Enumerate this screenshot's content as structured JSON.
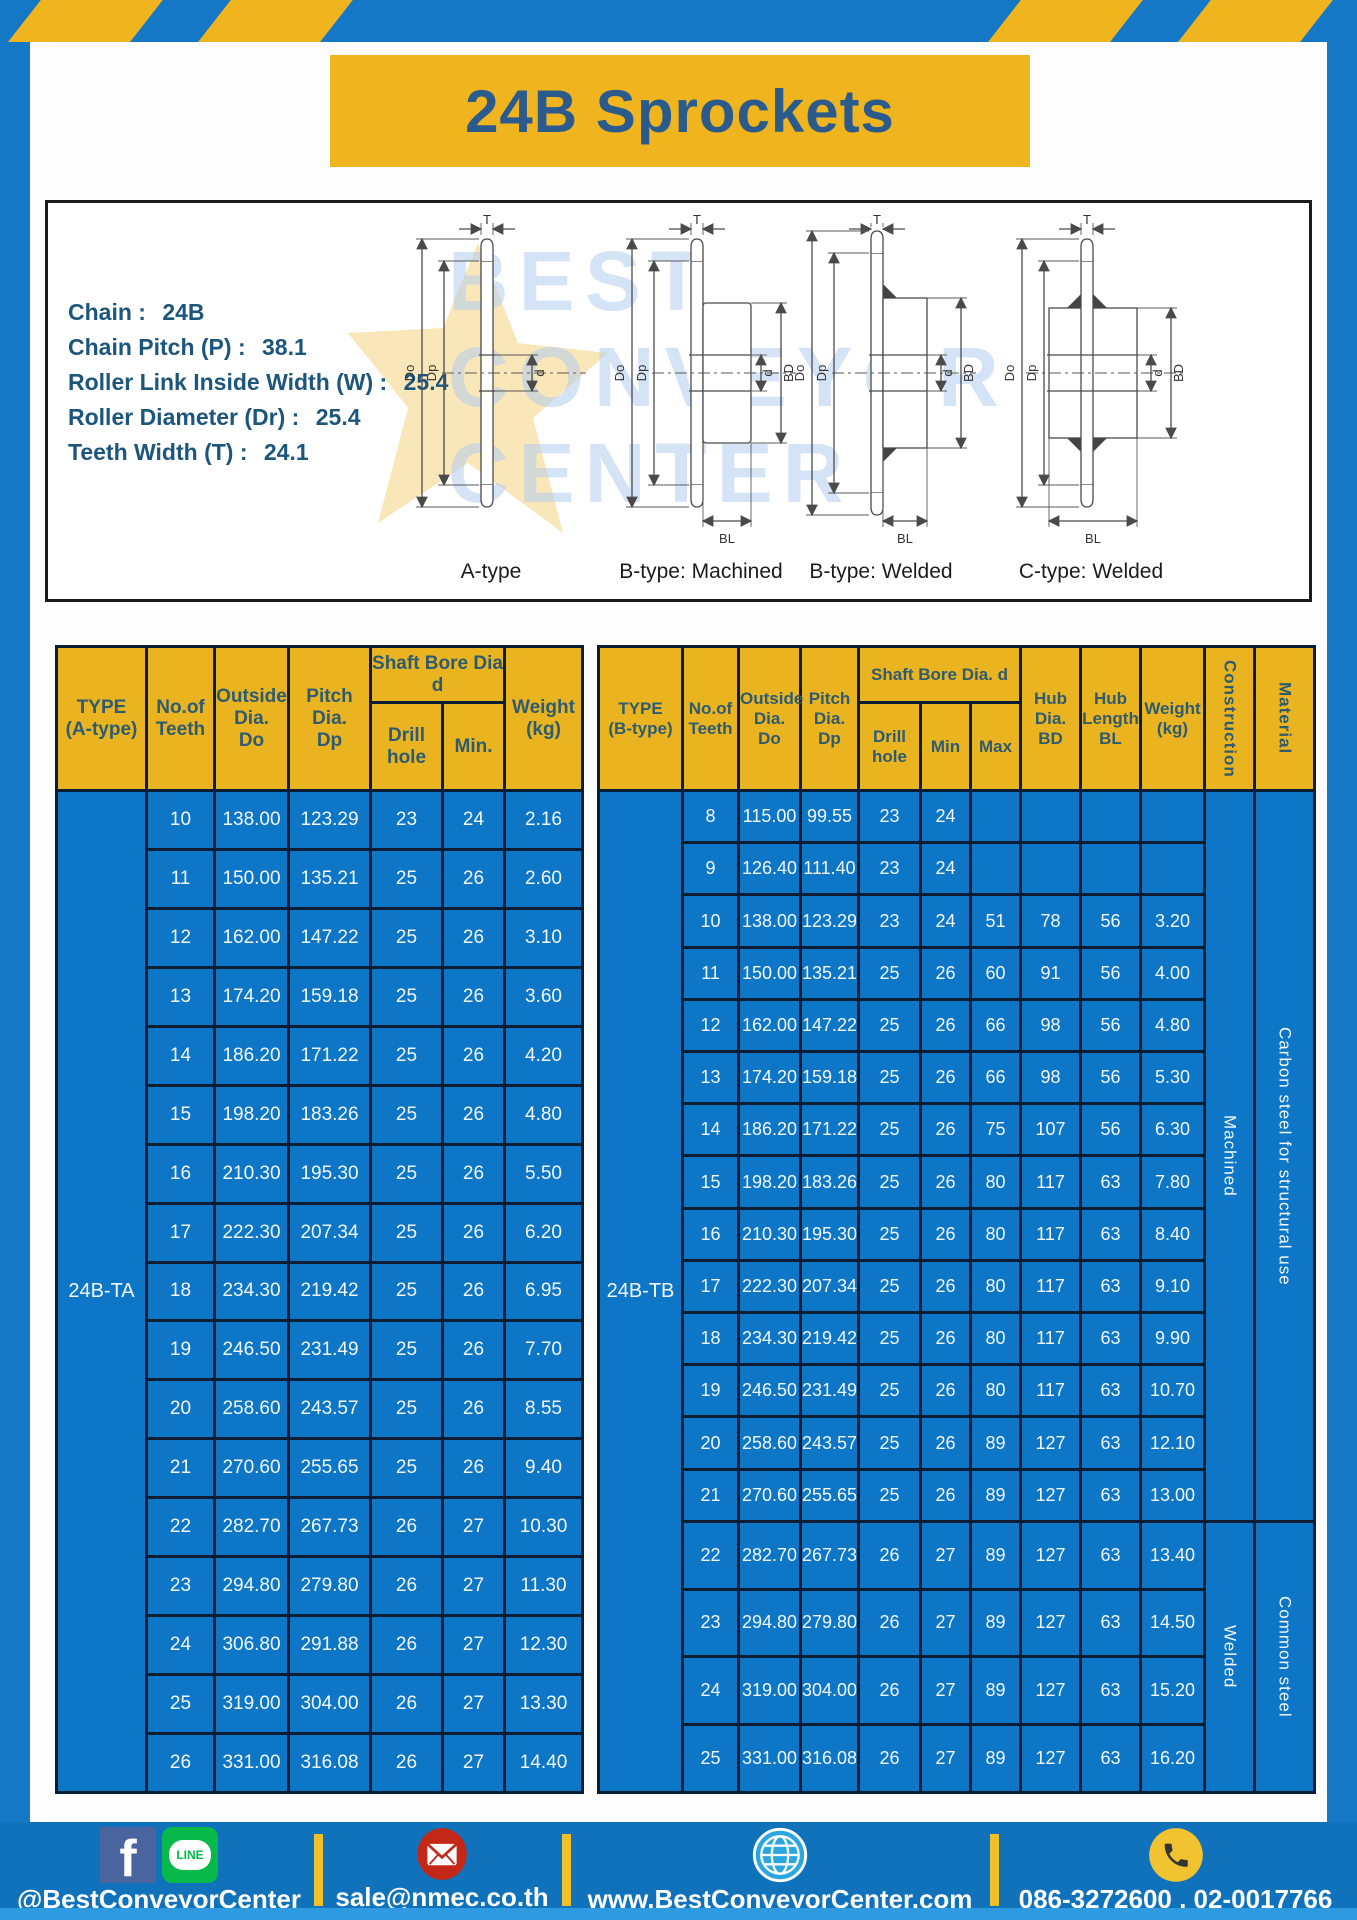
{
  "page": {
    "title": "24B Sprockets"
  },
  "colors": {
    "accent_yellow": "#EFB41E",
    "frame_blue": "#1478C6",
    "cell_blue": "#0E76C7",
    "footer_blue": "#1172BC",
    "border_dark": "#0A1D33",
    "header_text": "#2E5B70",
    "title_text": "#2B5B8C"
  },
  "specs": {
    "items": [
      {
        "label": "Chain",
        "value": "24B"
      },
      {
        "label": "Chain Pitch (P)",
        "value": "38.1"
      },
      {
        "label": "Roller Link Inside Width (W)",
        "value": "25.4"
      },
      {
        "label": "Roller Diameter (Dr)",
        "value": "25.4"
      },
      {
        "label": "Teeth Width (T)",
        "value": "24.1"
      }
    ]
  },
  "diagrams": {
    "captions": [
      "A-type",
      "B-type: Machined",
      "B-type: Welded",
      "C-type: Welded"
    ],
    "dim_labels": {
      "t": "T",
      "dia_o": "Do",
      "dia_p": "Dp",
      "d": "d",
      "bd": "BD",
      "bl": "BL"
    },
    "watermark_lines": [
      "BEST",
      "CONVEYOR",
      "CENTER"
    ]
  },
  "table_a": {
    "type_label": "24B-TA",
    "headers": {
      "type": "TYPE\n(A-type)",
      "teeth": "No.of\nTeeth",
      "outside": "Outside\nDia.\nDo",
      "pitch": "Pitch Dia.\nDp",
      "shaft_bore": "Shaft Bore Dia d",
      "drill": "Drill hole",
      "min": "Min.",
      "weight": "Weight\n(kg)"
    },
    "rows": [
      [
        "10",
        "138.00",
        "123.29",
        "23",
        "24",
        "2.16"
      ],
      [
        "11",
        "150.00",
        "135.21",
        "25",
        "26",
        "2.60"
      ],
      [
        "12",
        "162.00",
        "147.22",
        "25",
        "26",
        "3.10"
      ],
      [
        "13",
        "174.20",
        "159.18",
        "25",
        "26",
        "3.60"
      ],
      [
        "14",
        "186.20",
        "171.22",
        "25",
        "26",
        "4.20"
      ],
      [
        "15",
        "198.20",
        "183.26",
        "25",
        "26",
        "4.80"
      ],
      [
        "16",
        "210.30",
        "195.30",
        "25",
        "26",
        "5.50"
      ],
      [
        "17",
        "222.30",
        "207.34",
        "25",
        "26",
        "6.20"
      ],
      [
        "18",
        "234.30",
        "219.42",
        "25",
        "26",
        "6.95"
      ],
      [
        "19",
        "246.50",
        "231.49",
        "25",
        "26",
        "7.70"
      ],
      [
        "20",
        "258.60",
        "243.57",
        "25",
        "26",
        "8.55"
      ],
      [
        "21",
        "270.60",
        "255.65",
        "25",
        "26",
        "9.40"
      ],
      [
        "22",
        "282.70",
        "267.73",
        "26",
        "27",
        "10.30"
      ],
      [
        "23",
        "294.80",
        "279.80",
        "26",
        "27",
        "11.30"
      ],
      [
        "24",
        "306.80",
        "291.88",
        "26",
        "27",
        "12.30"
      ],
      [
        "25",
        "319.00",
        "304.00",
        "26",
        "27",
        "13.30"
      ],
      [
        "26",
        "331.00",
        "316.08",
        "26",
        "27",
        "14.40"
      ]
    ]
  },
  "table_b": {
    "type_label": "24B-TB",
    "headers": {
      "type": "TYPE\n(B-type)",
      "teeth": "No.of\nTeeth",
      "outside": "Outside\nDia.\nDo",
      "pitch": "Pitch\nDia.\nDp",
      "shaft_bore": "Shaft Bore Dia. d",
      "drill": "Drill hole",
      "min": "Min",
      "max": "Max",
      "hub_dia": "Hub\nDia.\nBD",
      "hub_len": "Hub\nLength\nBL",
      "weight": "Weight\n(kg)",
      "construction": "Construction",
      "material": "Material"
    },
    "rows": [
      [
        "8",
        "115.00",
        "99.55",
        "23",
        "24",
        "",
        "",
        "",
        ""
      ],
      [
        "9",
        "126.40",
        "111.40",
        "23",
        "24",
        "",
        "",
        "",
        ""
      ],
      [
        "10",
        "138.00",
        "123.29",
        "23",
        "24",
        "51",
        "78",
        "56",
        "3.20"
      ],
      [
        "11",
        "150.00",
        "135.21",
        "25",
        "26",
        "60",
        "91",
        "56",
        "4.00"
      ],
      [
        "12",
        "162.00",
        "147.22",
        "25",
        "26",
        "66",
        "98",
        "56",
        "4.80"
      ],
      [
        "13",
        "174.20",
        "159.18",
        "25",
        "26",
        "66",
        "98",
        "56",
        "5.30"
      ],
      [
        "14",
        "186.20",
        "171.22",
        "25",
        "26",
        "75",
        "107",
        "56",
        "6.30"
      ],
      [
        "15",
        "198.20",
        "183.26",
        "25",
        "26",
        "80",
        "117",
        "63",
        "7.80"
      ],
      [
        "16",
        "210.30",
        "195.30",
        "25",
        "26",
        "80",
        "117",
        "63",
        "8.40"
      ],
      [
        "17",
        "222.30",
        "207.34",
        "25",
        "26",
        "80",
        "117",
        "63",
        "9.10"
      ],
      [
        "18",
        "234.30",
        "219.42",
        "25",
        "26",
        "80",
        "117",
        "63",
        "9.90"
      ],
      [
        "19",
        "246.50",
        "231.49",
        "25",
        "26",
        "80",
        "117",
        "63",
        "10.70"
      ],
      [
        "20",
        "258.60",
        "243.57",
        "25",
        "26",
        "89",
        "127",
        "63",
        "12.10"
      ],
      [
        "21",
        "270.60",
        "255.65",
        "25",
        "26",
        "89",
        "127",
        "63",
        "13.00"
      ],
      [
        "22",
        "282.70",
        "267.73",
        "26",
        "27",
        "89",
        "127",
        "63",
        "13.40"
      ],
      [
        "23",
        "294.80",
        "279.80",
        "26",
        "27",
        "89",
        "127",
        "63",
        "14.50"
      ],
      [
        "24",
        "319.00",
        "304.00",
        "26",
        "27",
        "89",
        "127",
        "63",
        "15.20"
      ],
      [
        "25",
        "331.00",
        "316.08",
        "26",
        "27",
        "89",
        "127",
        "63",
        "16.20"
      ]
    ],
    "groups": [
      {
        "start": 0,
        "span": 14,
        "construction": "Machined",
        "material": "Carbon steel for structural use"
      },
      {
        "start": 14,
        "span": 4,
        "construction": "Welded",
        "material": "Common steel"
      }
    ]
  },
  "footer": {
    "social_handle": "@BestConveyorCenter",
    "line_label": "LINE",
    "email": "sale@nmec.co.th",
    "website": "www.BestConveyorCenter.com",
    "phone": "086-3272600 , 02-0017766"
  }
}
